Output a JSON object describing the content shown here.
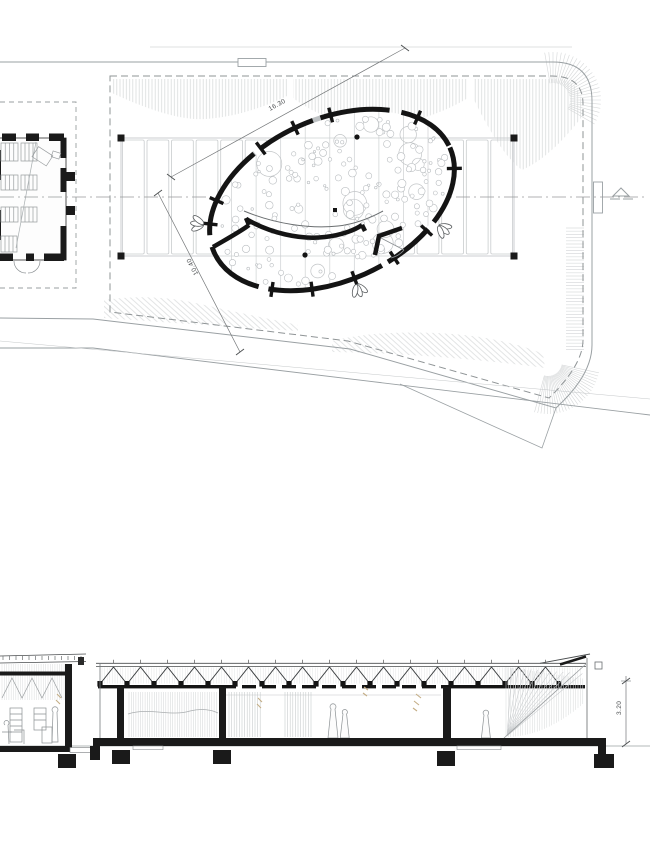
{
  "plan": {
    "dimensions": {
      "major_axis": "16.30",
      "minor_axis": "10.40"
    }
  },
  "section": {
    "dimensions": {
      "height": "3.20"
    }
  },
  "icons": {
    "gable_marker": "triangle outline on boundary centerline"
  },
  "colors": {
    "ink": "#141414",
    "boundary_gray": "#9aa0a3",
    "hatch_gray": "#d9dbdc",
    "grid_gray": "#c6c9cb",
    "sketch_beige": "#c4ad85",
    "background": "#ffffff"
  }
}
